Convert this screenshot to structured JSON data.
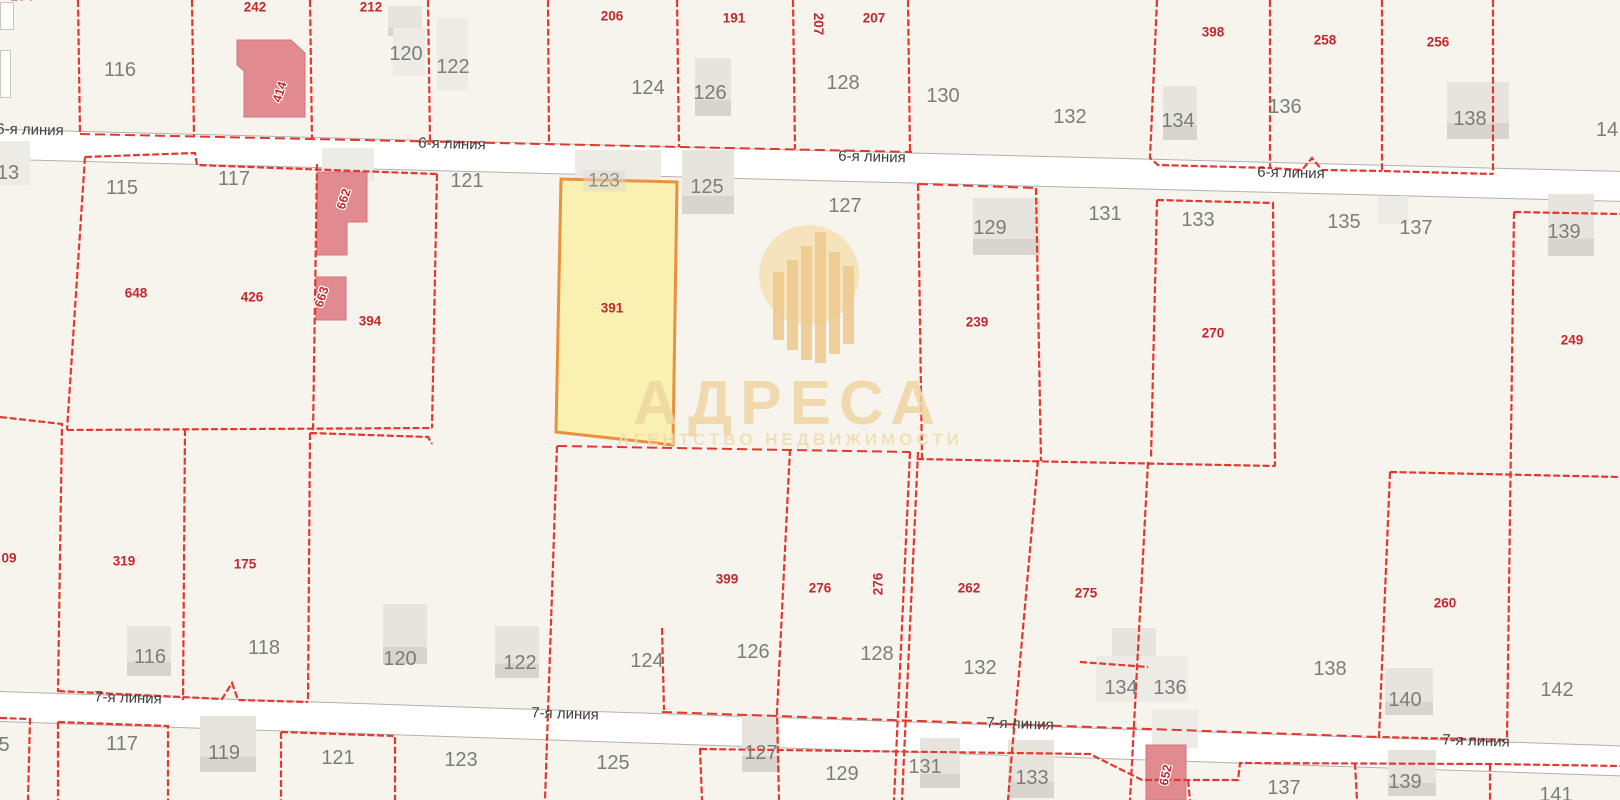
{
  "app": {
    "name": "cadastral-map-view"
  },
  "watermark": {
    "title": "АДРЕСА",
    "subtitle": "АГЕНТСТВО НЕДВИЖИМОСТИ"
  },
  "highlight": {
    "house_number": "123",
    "parcel_number": "391"
  },
  "colors": {
    "background": "#f7f4ee",
    "boundary_red": "#e23830",
    "parcel_number_red": "#c2282e",
    "house_number_gray": "#7c7c78",
    "street_text": "#3e3e3c",
    "highlight_fill": "#f9efab",
    "highlight_border": "#e8913f",
    "building_gray": "#e7e4de",
    "building_pink": "#e18b90",
    "watermark_gold": "#eed5a2",
    "road_fill": "#ffffff"
  },
  "map": {
    "streets": [
      {
        "name": "6-я линия",
        "tilt": 1.5,
        "labels": [
          {
            "x": 30,
            "y": 130
          },
          {
            "x": 452,
            "y": 144
          },
          {
            "x": 872,
            "y": 157
          },
          {
            "x": 1291,
            "y": 173
          }
        ]
      },
      {
        "name": "7-я линия",
        "tilt": 1.9,
        "labels": [
          {
            "x": 128,
            "y": 698
          },
          {
            "x": 565,
            "y": 714
          },
          {
            "x": 1020,
            "y": 724
          },
          {
            "x": 1476,
            "y": 741
          }
        ]
      }
    ],
    "red_parcel_numbers": [
      {
        "t": "204",
        "x": 22,
        "y": -4
      },
      {
        "t": "242",
        "x": 255,
        "y": 7
      },
      {
        "t": "212",
        "x": 371,
        "y": 7
      },
      {
        "t": "206",
        "x": 612,
        "y": 16
      },
      {
        "t": "191",
        "x": 734,
        "y": 18
      },
      {
        "t": "207",
        "x": 818,
        "y": 24,
        "r": 90
      },
      {
        "t": "207",
        "x": 874,
        "y": 18
      },
      {
        "t": "398",
        "x": 1213,
        "y": 32
      },
      {
        "t": "258",
        "x": 1325,
        "y": 40
      },
      {
        "t": "256",
        "x": 1438,
        "y": 42
      },
      {
        "t": "648",
        "x": 136,
        "y": 293
      },
      {
        "t": "426",
        "x": 252,
        "y": 297
      },
      {
        "t": "394",
        "x": 370,
        "y": 321
      },
      {
        "t": "391",
        "x": 612,
        "y": 308
      },
      {
        "t": "239",
        "x": 977,
        "y": 322
      },
      {
        "t": "270",
        "x": 1213,
        "y": 333
      },
      {
        "t": "249",
        "x": 1572,
        "y": 340
      },
      {
        "t": "09",
        "x": 9,
        "y": 558
      },
      {
        "t": "319",
        "x": 124,
        "y": 561
      },
      {
        "t": "175",
        "x": 245,
        "y": 564
      },
      {
        "t": "399",
        "x": 727,
        "y": 579
      },
      {
        "t": "276",
        "x": 820,
        "y": 588
      },
      {
        "t": "276",
        "x": 878,
        "y": 584,
        "r": -90
      },
      {
        "t": "262",
        "x": 969,
        "y": 588
      },
      {
        "t": "275",
        "x": 1086,
        "y": 593
      },
      {
        "t": "260",
        "x": 1445,
        "y": 603
      }
    ],
    "building_numbers": [
      {
        "t": "414",
        "x": 280,
        "y": 92,
        "r": -72
      },
      {
        "t": "662",
        "x": 344,
        "y": 199,
        "r": -72
      },
      {
        "t": "663",
        "x": 322,
        "y": 297,
        "r": -72
      },
      {
        "t": "652",
        "x": 1166,
        "y": 775,
        "r": -78
      }
    ],
    "gray_house_numbers": [
      {
        "t": "116",
        "x": 120,
        "y": 70
      },
      {
        "t": "120",
        "x": 406,
        "y": 54
      },
      {
        "t": "122",
        "x": 453,
        "y": 67
      },
      {
        "t": "124",
        "x": 648,
        "y": 88
      },
      {
        "t": "126",
        "x": 710,
        "y": 93
      },
      {
        "t": "128",
        "x": 843,
        "y": 83
      },
      {
        "t": "130",
        "x": 943,
        "y": 96
      },
      {
        "t": "132",
        "x": 1070,
        "y": 117
      },
      {
        "t": "134",
        "x": 1178,
        "y": 121
      },
      {
        "t": "136",
        "x": 1285,
        "y": 107
      },
      {
        "t": "138",
        "x": 1470,
        "y": 119
      },
      {
        "t": "14",
        "x": 1607,
        "y": 130
      },
      {
        "t": "13",
        "x": 8,
        "y": 173
      },
      {
        "t": "115",
        "x": 122,
        "y": 188
      },
      {
        "t": "117",
        "x": 234,
        "y": 179
      },
      {
        "t": "121",
        "x": 467,
        "y": 181
      },
      {
        "t": "125",
        "x": 707,
        "y": 187
      },
      {
        "t": "127",
        "x": 845,
        "y": 206
      },
      {
        "t": "129",
        "x": 990,
        "y": 228
      },
      {
        "t": "131",
        "x": 1105,
        "y": 214
      },
      {
        "t": "133",
        "x": 1198,
        "y": 220
      },
      {
        "t": "135",
        "x": 1344,
        "y": 222
      },
      {
        "t": "137",
        "x": 1416,
        "y": 228
      },
      {
        "t": "139",
        "x": 1564,
        "y": 232
      },
      {
        "t": "116",
        "x": 150,
        "y": 657
      },
      {
        "t": "118",
        "x": 264,
        "y": 648
      },
      {
        "t": "120",
        "x": 400,
        "y": 659
      },
      {
        "t": "122",
        "x": 520,
        "y": 663
      },
      {
        "t": "124",
        "x": 647,
        "y": 661
      },
      {
        "t": "126",
        "x": 753,
        "y": 652
      },
      {
        "t": "128",
        "x": 877,
        "y": 654
      },
      {
        "t": "132",
        "x": 980,
        "y": 668
      },
      {
        "t": "134",
        "x": 1121,
        "y": 688
      },
      {
        "t": "136",
        "x": 1170,
        "y": 688
      },
      {
        "t": "138",
        "x": 1330,
        "y": 669
      },
      {
        "t": "140",
        "x": 1405,
        "y": 700
      },
      {
        "t": "142",
        "x": 1557,
        "y": 690
      },
      {
        "t": "5",
        "x": 4,
        "y": 745
      },
      {
        "t": "117",
        "x": 122,
        "y": 744
      },
      {
        "t": "119",
        "x": 224,
        "y": 753
      },
      {
        "t": "121",
        "x": 338,
        "y": 758
      },
      {
        "t": "123",
        "x": 461,
        "y": 760
      },
      {
        "t": "125",
        "x": 613,
        "y": 763
      },
      {
        "t": "127",
        "x": 761,
        "y": 753
      },
      {
        "t": "129",
        "x": 842,
        "y": 774
      },
      {
        "t": "131",
        "x": 925,
        "y": 767
      },
      {
        "t": "133",
        "x": 1032,
        "y": 778
      },
      {
        "t": "137",
        "x": 1284,
        "y": 788
      },
      {
        "t": "139",
        "x": 1405,
        "y": 782
      },
      {
        "t": "141",
        "x": 1556,
        "y": 795
      }
    ],
    "highlight_chip": {
      "t": "123",
      "x": 604,
      "y": 181
    },
    "buildings": [
      {
        "x": 388,
        "y": 6,
        "w": 34,
        "h": 30
      },
      {
        "x": 393,
        "y": 28,
        "w": 32,
        "h": 48,
        "t": "l"
      },
      {
        "x": 437,
        "y": 18,
        "w": 31,
        "h": 72,
        "t": "l"
      },
      {
        "x": 695,
        "y": 58,
        "w": 36,
        "h": 58
      },
      {
        "x": 682,
        "y": 150,
        "w": 52,
        "h": 64
      },
      {
        "x": 575,
        "y": 150,
        "w": 86,
        "h": 30,
        "t": "l"
      },
      {
        "x": 322,
        "y": 148,
        "w": 52,
        "h": 34,
        "t": "l"
      },
      {
        "x": 973,
        "y": 198,
        "w": 67,
        "h": 57
      },
      {
        "x": 1163,
        "y": 86,
        "w": 34,
        "h": 54
      },
      {
        "x": 1447,
        "y": 82,
        "w": 62,
        "h": 57
      },
      {
        "x": 1378,
        "y": 196,
        "w": 30,
        "h": 28,
        "t": "l"
      },
      {
        "x": 1548,
        "y": 194,
        "w": 46,
        "h": 62
      },
      {
        "x": 0,
        "y": 141,
        "w": 30,
        "h": 44,
        "t": "l"
      },
      {
        "x": 0,
        "y": 2,
        "w": 12,
        "h": 26,
        "t": "o"
      },
      {
        "x": 0,
        "y": 50,
        "w": 9,
        "h": 46,
        "t": "o"
      },
      {
        "x": 127,
        "y": 626,
        "w": 44,
        "h": 50
      },
      {
        "x": 383,
        "y": 604,
        "w": 44,
        "h": 60
      },
      {
        "x": 495,
        "y": 626,
        "w": 44,
        "h": 52
      },
      {
        "x": 200,
        "y": 716,
        "w": 56,
        "h": 56
      },
      {
        "x": 742,
        "y": 714,
        "w": 38,
        "h": 58
      },
      {
        "x": 920,
        "y": 738,
        "w": 40,
        "h": 50
      },
      {
        "x": 1112,
        "y": 628,
        "w": 44,
        "h": 64
      },
      {
        "x": 1096,
        "y": 656,
        "w": 92,
        "h": 46,
        "t": "l"
      },
      {
        "x": 1008,
        "y": 740,
        "w": 46,
        "h": 58
      },
      {
        "x": 1152,
        "y": 710,
        "w": 46,
        "h": 38,
        "t": "l"
      },
      {
        "x": 1388,
        "y": 750,
        "w": 48,
        "h": 46
      },
      {
        "x": 1385,
        "y": 668,
        "w": 48,
        "h": 47
      }
    ],
    "watermark_bars": [
      {
        "x": 773,
        "y": 272,
        "h": 68
      },
      {
        "x": 787,
        "y": 260,
        "h": 90
      },
      {
        "x": 801,
        "y": 246,
        "h": 114
      },
      {
        "x": 815,
        "y": 232,
        "h": 131
      },
      {
        "x": 829,
        "y": 252,
        "h": 102
      },
      {
        "x": 843,
        "y": 266,
        "h": 78
      }
    ]
  }
}
